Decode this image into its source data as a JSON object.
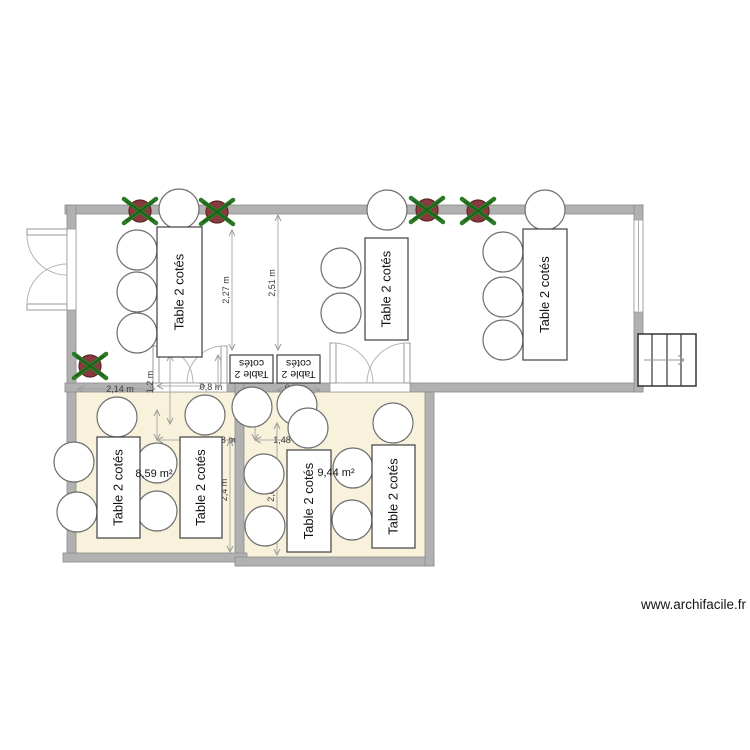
{
  "labels": {
    "table": "Table 2 cotés",
    "table_flip_line1": "Table 2",
    "table_flip_line2": "cotés",
    "watermark": "www.archifacile.fr"
  },
  "colors": {
    "wall": "#b1b1b1",
    "wall_edge": "#8d8d8d",
    "room_fill": "#f8f2dc",
    "chair_stroke": "#6e6e6e",
    "table_stroke": "#3f3f3f",
    "dim": "#9a9a9a",
    "dim_text": "#3a3a3a",
    "door": "#999999",
    "arc": "#b5b5b5",
    "plant_pot": "#8a3a3e",
    "plant_pot_edge": "#5d2527",
    "plant_leaf": "#2c7a26",
    "plant_leaf_dark": "#1e5c1a",
    "stairs_stroke": "#333333",
    "stairs_arrow": "#999999"
  },
  "rooms": [
    {
      "x": 76,
      "y": 392,
      "w": 159,
      "h": 161
    },
    {
      "x": 244,
      "y": 392,
      "w": 181,
      "h": 165
    }
  ],
  "area_labels": [
    {
      "text": "8,59 m²",
      "x": 154,
      "y": 477
    },
    {
      "text": "9,44 m²",
      "x": 336,
      "y": 476
    }
  ],
  "walls": [
    {
      "x": 65,
      "y": 205,
      "w": 578,
      "h": 9
    },
    {
      "x": 67,
      "y": 205,
      "w": 9,
      "h": 357
    },
    {
      "x": 65,
      "y": 383,
      "w": 578,
      "h": 9
    },
    {
      "x": 634,
      "y": 205,
      "w": 9,
      "h": 187
    },
    {
      "x": 235,
      "y": 383,
      "w": 9,
      "h": 183
    },
    {
      "x": 63,
      "y": 553,
      "w": 184,
      "h": 9
    },
    {
      "x": 235,
      "y": 557,
      "w": 199,
      "h": 9
    },
    {
      "x": 425,
      "y": 392,
      "w": 9,
      "h": 174
    }
  ],
  "gaps": [
    {
      "kind": "door-gap",
      "x": 153,
      "y": 383,
      "w": 74,
      "h": 9,
      "line": ""
    },
    {
      "kind": "door-gap",
      "x": 330,
      "y": 383,
      "w": 80,
      "h": 9,
      "line": ""
    },
    {
      "kind": "door-gap",
      "x": 67,
      "y": 229,
      "w": 9,
      "h": 81,
      "line": ""
    },
    {
      "kind": "window",
      "x": 634,
      "y": 220,
      "w": 9,
      "h": 92,
      "line": "M638.5,221 L638.5,311"
    }
  ],
  "door_leaves": [
    {
      "x": 27,
      "y": 229,
      "w": 40,
      "h": 6
    },
    {
      "x": 27,
      "y": 304,
      "w": 40,
      "h": 6
    },
    {
      "x": 153,
      "y": 346,
      "w": 6,
      "h": 37
    },
    {
      "x": 221,
      "y": 346,
      "w": 6,
      "h": 37
    },
    {
      "x": 330,
      "y": 343,
      "w": 6,
      "h": 40
    },
    {
      "x": 404,
      "y": 343,
      "w": 6,
      "h": 40
    }
  ],
  "door_arcs": [
    "M27,235 A40,40 0 0 0 67,275",
    "M27,304 A40,40 0 0 1 67,264",
    "M156,346 A37,37 0 0 1 193,383",
    "M224,346 A37,37 0 0 0 187,383",
    "M333,343 A40,40 0 0 1 373,383",
    "M407,343 A40,40 0 0 0 367,383"
  ],
  "tables": [
    {
      "x": 157,
      "y": 227,
      "w": 45,
      "h": 130,
      "type": "v"
    },
    {
      "x": 365,
      "y": 238,
      "w": 43,
      "h": 102,
      "type": "v"
    },
    {
      "x": 523,
      "y": 229,
      "w": 44,
      "h": 131,
      "type": "v"
    },
    {
      "x": 230,
      "y": 355,
      "w": 43,
      "h": 28,
      "type": "flip"
    },
    {
      "x": 277,
      "y": 355,
      "w": 43,
      "h": 28,
      "type": "flip"
    },
    {
      "x": 97,
      "y": 437,
      "w": 43,
      "h": 101,
      "type": "v"
    },
    {
      "x": 180,
      "y": 437,
      "w": 42,
      "h": 101,
      "type": "v"
    },
    {
      "x": 287,
      "y": 450,
      "w": 44,
      "h": 102,
      "type": "v"
    },
    {
      "x": 372,
      "y": 445,
      "w": 43,
      "h": 103,
      "type": "v"
    }
  ],
  "chairs": [
    [
      179,
      209
    ],
    [
      137,
      250
    ],
    [
      137,
      292
    ],
    [
      137,
      333
    ],
    [
      387,
      210
    ],
    [
      341,
      268
    ],
    [
      341,
      313
    ],
    [
      545,
      210
    ],
    [
      503,
      252
    ],
    [
      503,
      297
    ],
    [
      503,
      340
    ],
    [
      252,
      407
    ],
    [
      297,
      405
    ],
    [
      117,
      417
    ],
    [
      205,
      415
    ],
    [
      74,
      462
    ],
    [
      77,
      512
    ],
    [
      157,
      463
    ],
    [
      157,
      511
    ],
    [
      308,
      428
    ],
    [
      393,
      423
    ],
    [
      264,
      474
    ],
    [
      265,
      526
    ],
    [
      353,
      468
    ],
    [
      352,
      520
    ]
  ],
  "chair_radius": 20,
  "plants": [
    [
      140,
      211
    ],
    [
      217,
      212
    ],
    [
      427,
      210
    ],
    [
      478,
      211
    ],
    [
      90,
      366
    ]
  ],
  "stairs": {
    "x": 638,
    "y": 334,
    "w": 58,
    "h": 52,
    "steps_x": [
      652,
      667,
      681
    ],
    "arrow": {
      "x1": 644,
      "x2": 684,
      "y": 360
    }
  },
  "dims_h": [
    {
      "x1": 78,
      "x2": 155,
      "y": 389,
      "label": "2,14 m",
      "lx": 120,
      "ly": 392
    },
    {
      "x1": 157,
      "x2": 205,
      "y": 386,
      "label": "0,8 m",
      "lx": 211,
      "ly": 390
    },
    {
      "x1": 277,
      "x2": 320,
      "y": 390,
      "label": "0,8 m",
      "lx": 296,
      "ly": 391
    },
    {
      "x1": 157,
      "x2": 235,
      "y": 440,
      "label": "1,48 m",
      "lx": 222,
      "ly": 443
    },
    {
      "x1": 255,
      "x2": 318,
      "y": 440,
      "label": "1,48 m",
      "lx": 287,
      "ly": 443
    }
  ],
  "dims_v": [
    {
      "y1": 230,
      "y2": 350,
      "x": 232,
      "label": "2,27 m",
      "lx": 229,
      "ly": 290
    },
    {
      "y1": 215,
      "y2": 350,
      "x": 278,
      "label": "2,51 m",
      "lx": 275,
      "ly": 283
    },
    {
      "y1": 355,
      "y2": 424,
      "x": 170,
      "label": "1,2 m",
      "lx": 153,
      "ly": 382
    },
    {
      "y1": 355,
      "y2": 389,
      "x": 218,
      "label": "",
      "lx": 0,
      "ly": 0
    },
    {
      "y1": 440,
      "y2": 552,
      "x": 230,
      "label": "2,4 m",
      "lx": 227,
      "ly": 490
    },
    {
      "y1": 423,
      "y2": 555,
      "x": 277,
      "label": "2,04 m",
      "lx": 274,
      "ly": 488
    },
    {
      "y1": 420,
      "y2": 440,
      "x": 255,
      "label": "",
      "lx": 0,
      "ly": 0
    },
    {
      "y1": 410,
      "y2": 440,
      "x": 157,
      "label": "",
      "lx": 0,
      "ly": 0
    }
  ],
  "watermark_pos": {
    "x": 746,
    "y": 609
  }
}
